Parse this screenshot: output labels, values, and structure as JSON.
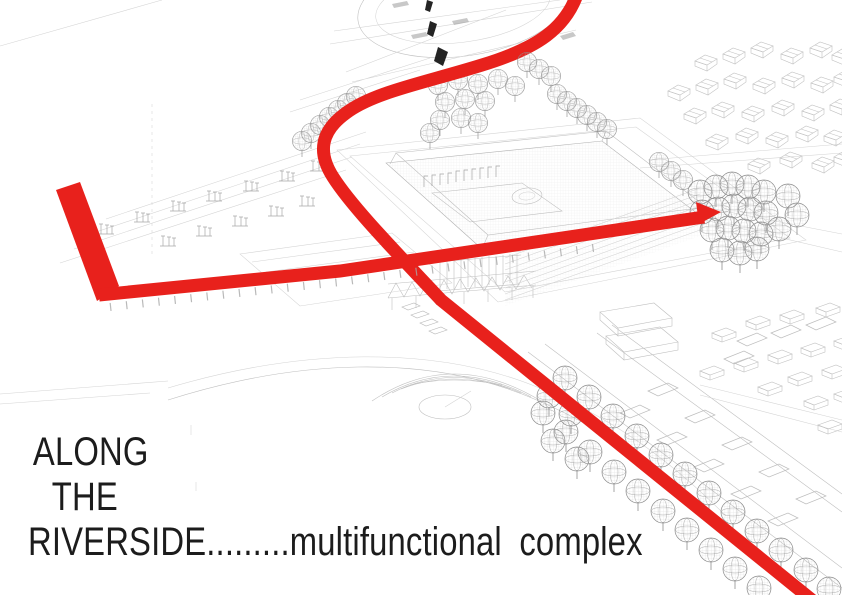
{
  "caption": {
    "line1": "ALONG",
    "line2": "THE",
    "line3": "RIVERSIDE.........multifunctional complex"
  },
  "colors": {
    "background": "#ffffff",
    "accent_red": "#e8211c",
    "wireframe_gray": "#bfbfbf",
    "tree_gray": "#8e8e8e",
    "text_black": "#1c1c1c",
    "marker_black": "#242424"
  }
}
